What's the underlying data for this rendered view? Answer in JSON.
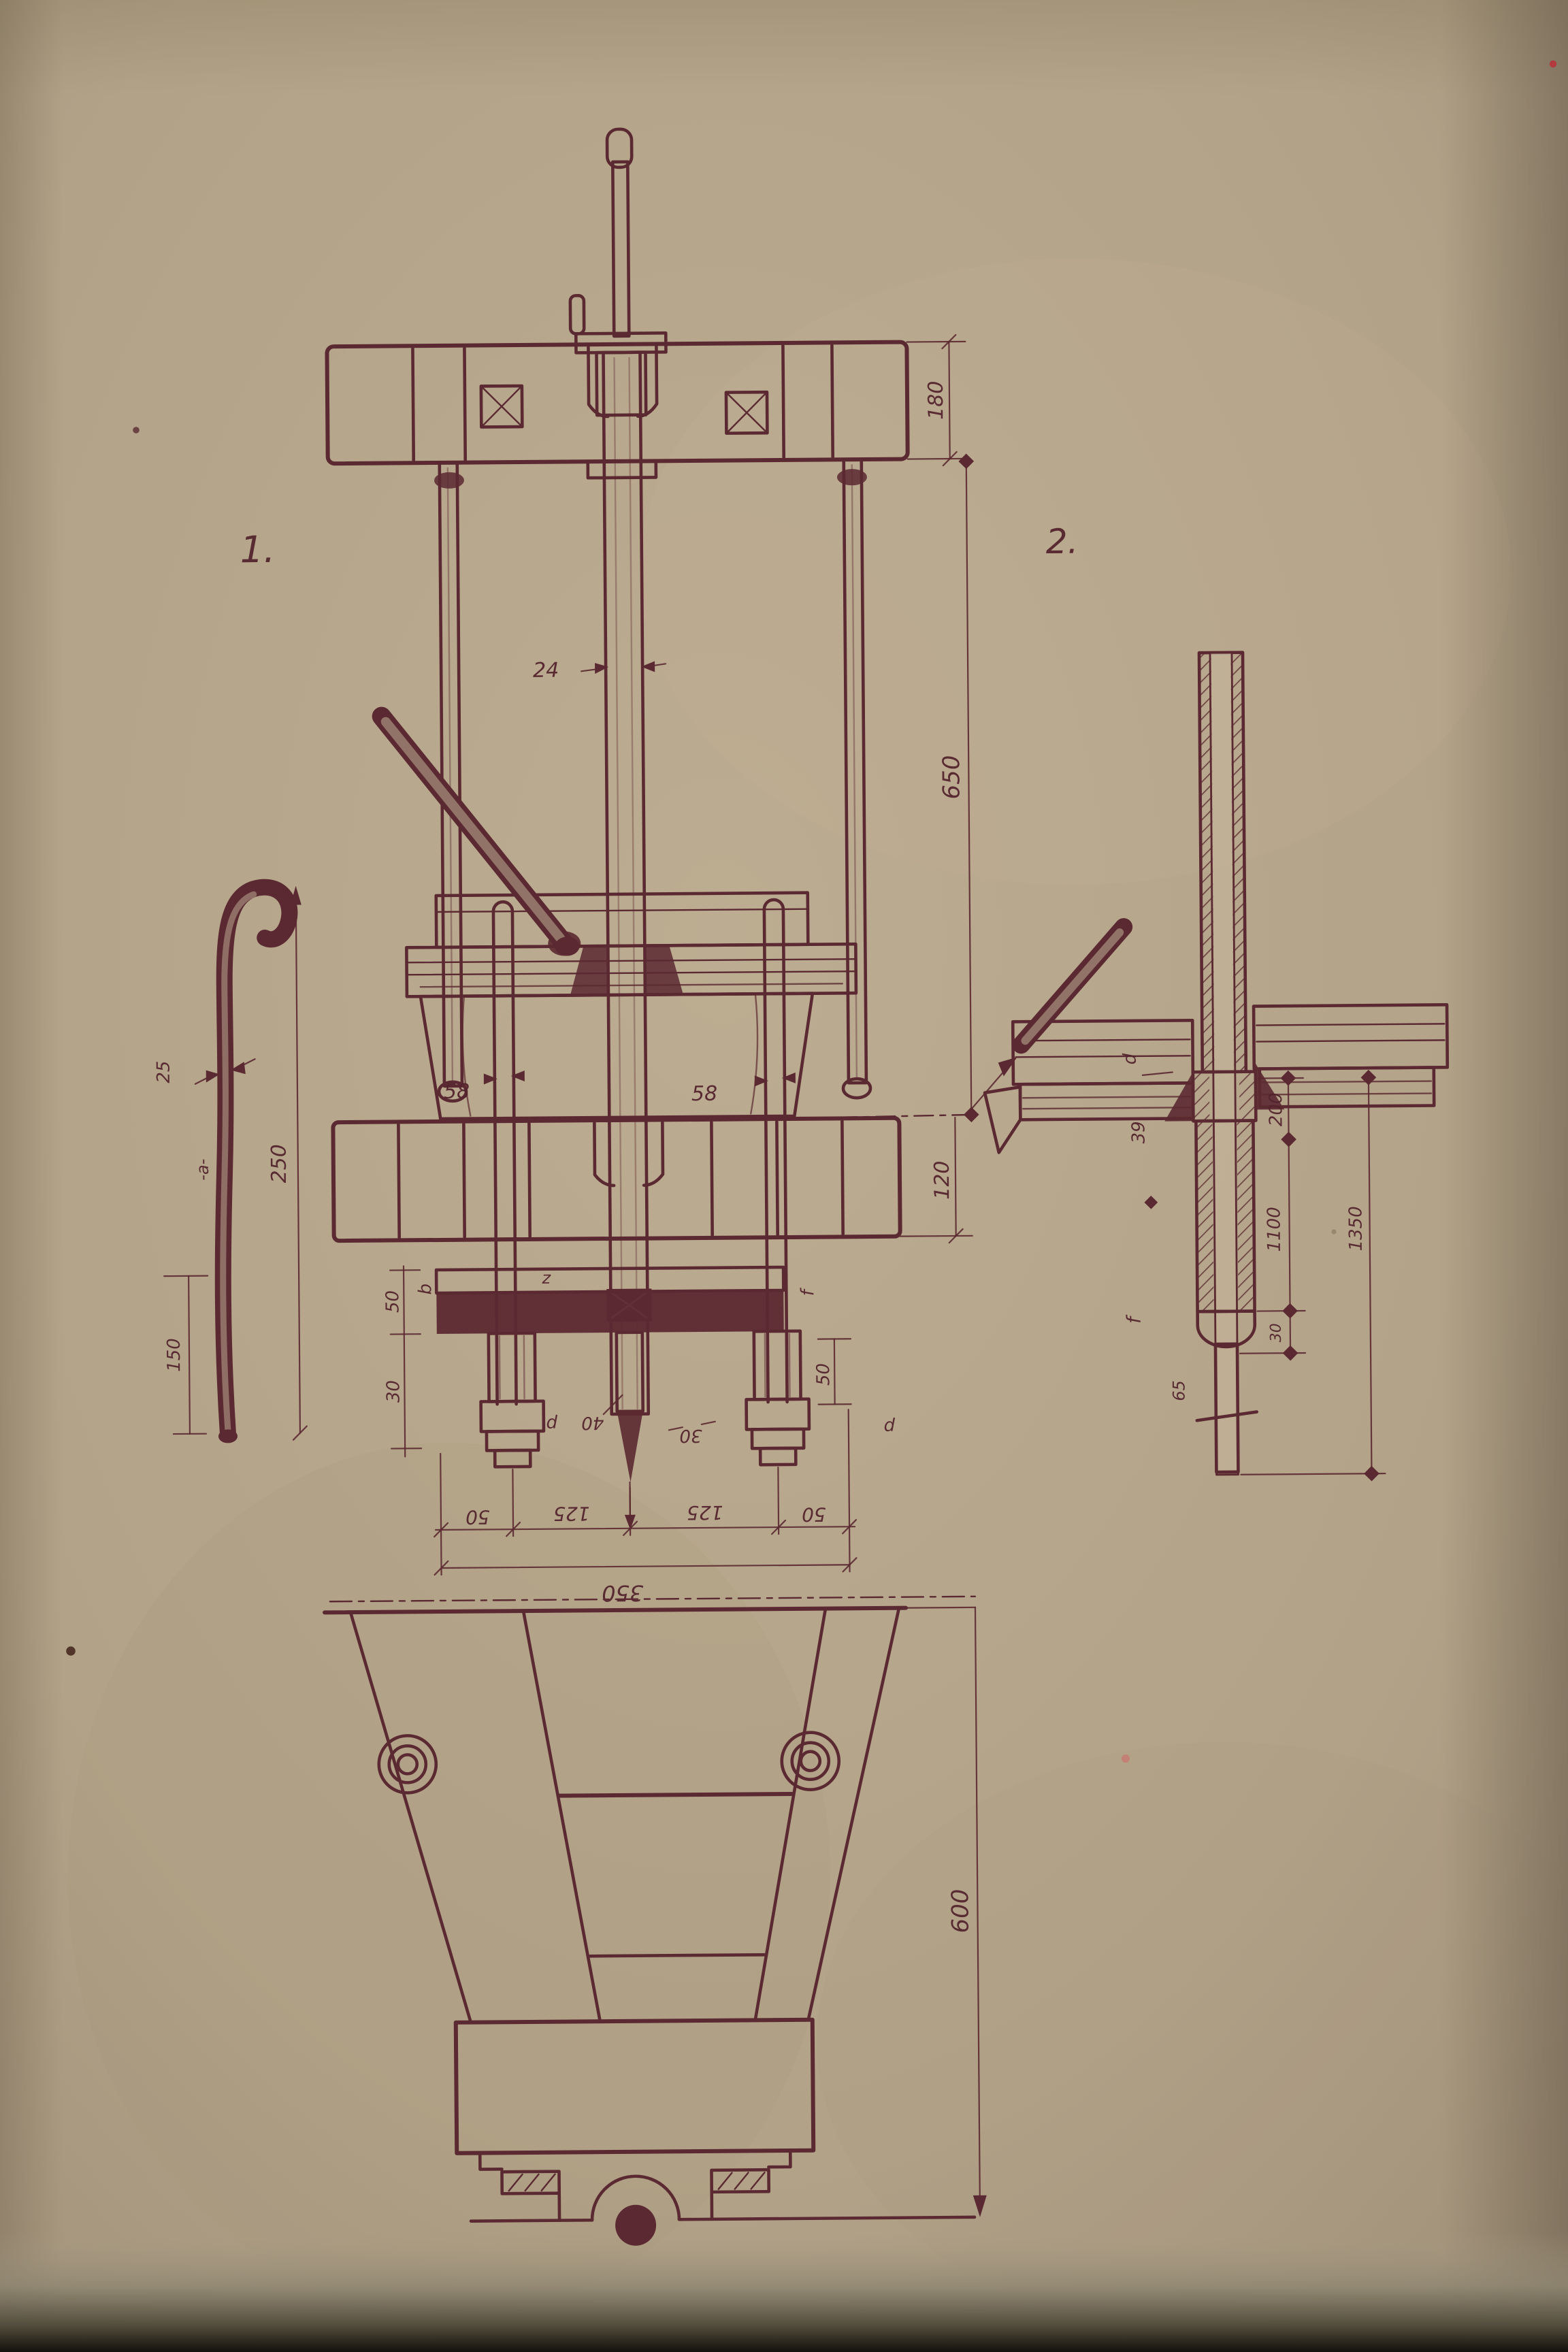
{
  "photo": {
    "paper_color": "#b2a288",
    "ink_color": "#5b2931"
  },
  "drawing": {
    "figure1": {
      "label": "1.",
      "dims": {
        "beam_height": "180",
        "clear_span": "650",
        "lower_beam_height": "120",
        "center_rod_dia": "24",
        "left_rod_dia": "58",
        "right_rod_dia": "58",
        "chain": [
          "50",
          "125",
          "125",
          "50"
        ],
        "total_width": "350",
        "left_upper": "50",
        "left_lower": "30",
        "center_left": "40",
        "center_right": "30",
        "right_bracket": "50"
      },
      "refs": {
        "z": "z",
        "b": "b",
        "f": "f",
        "d_left": "d",
        "d_right": "d"
      }
    },
    "hook": {
      "diameter": "25",
      "section": "-a-",
      "length": "250",
      "lower_length": "150"
    },
    "figure2": {
      "label": "2.",
      "dims": {
        "upper": "200",
        "middle": "1100",
        "overall": "1350",
        "step": "30",
        "tip": "65"
      },
      "refs": {
        "collar": "d",
        "rod_dia": "39",
        "pin": "f"
      }
    },
    "base": {
      "height": "600"
    }
  }
}
